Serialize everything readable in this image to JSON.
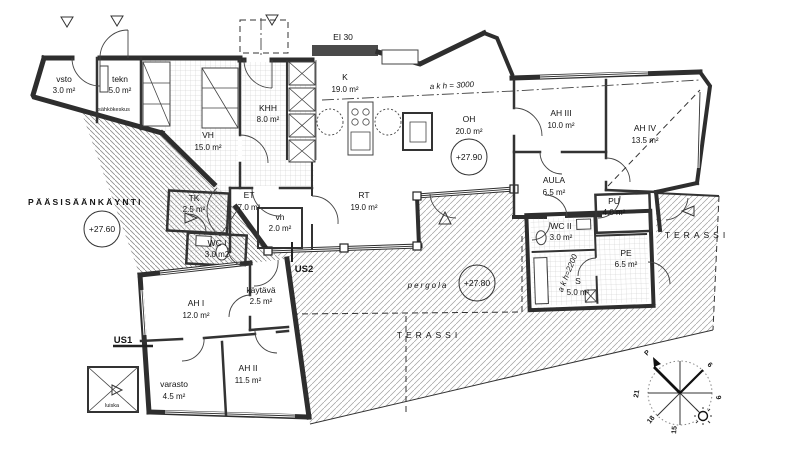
{
  "title": "floor-plan",
  "rooms": {
    "vsto": {
      "name": "vsto",
      "area": "3.0 m²"
    },
    "tekn": {
      "name": "tekn",
      "area": "5.0 m²"
    },
    "khh": {
      "name": "KHH",
      "area": "8.0 m²"
    },
    "vh": {
      "name": "VH",
      "area": "15.0 m²"
    },
    "k": {
      "name": "K",
      "area": "19.0 m²"
    },
    "oh": {
      "name": "OH",
      "area": "20.0 m²"
    },
    "ah3": {
      "name": "AH III",
      "area": "10.0 m²"
    },
    "ah4": {
      "name": "AH IV",
      "area": "13.5 m²"
    },
    "aula": {
      "name": "AULA",
      "area": "6.5 m²"
    },
    "pu": {
      "name": "PU",
      "area": "4.0 m²"
    },
    "tk": {
      "name": "TK",
      "area": "2.5 m²"
    },
    "wc1": {
      "name": "WC I",
      "area": "3.0 m2"
    },
    "et": {
      "name": "ET",
      "area": "7.0 m²"
    },
    "vh2": {
      "name": "vh",
      "area": "2.0 m²"
    },
    "rt": {
      "name": "RT",
      "area": "19.0 m²"
    },
    "kaytava": {
      "name": "käytävä",
      "area": "2.5 m²"
    },
    "ah1": {
      "name": "AH I",
      "area": "12.0 m²"
    },
    "varasto": {
      "name": "varasto",
      "area": "4.5 m²"
    },
    "ah2": {
      "name": "AH II",
      "area": "11.5 m²"
    },
    "wc2": {
      "name": "WC II",
      "area": "3.0 m²"
    },
    "s": {
      "name": "S",
      "area": "5.0 m²"
    },
    "pe": {
      "name": "PE",
      "area": "6.5 m²"
    }
  },
  "levels": {
    "entrance": "+27.60",
    "living": "+27.90",
    "pergola": "+27.80"
  },
  "annotations": {
    "ei30": "EI 30",
    "akh_living": "a k h = 3000",
    "akh_sauna": "a k h=2200",
    "us1": "US1",
    "us2": "US2",
    "sahkokeskus": "sähkökeskus",
    "entrance": "PÄÄSISÄÄNKÄYNTI",
    "terassi_right": "TERASSI",
    "terassi_main": "TERASSI",
    "pergola": "pergola",
    "luiska": "luiska"
  },
  "compass": {
    "north": "P",
    "h6": "6",
    "h9": "9",
    "h15": "15",
    "h18": "18",
    "h21": "21"
  },
  "colors": {
    "ink": "#2e2e2e",
    "hatch": "#9f9f9f",
    "tile": "#c8c8c8",
    "paper": "#ffffff"
  }
}
